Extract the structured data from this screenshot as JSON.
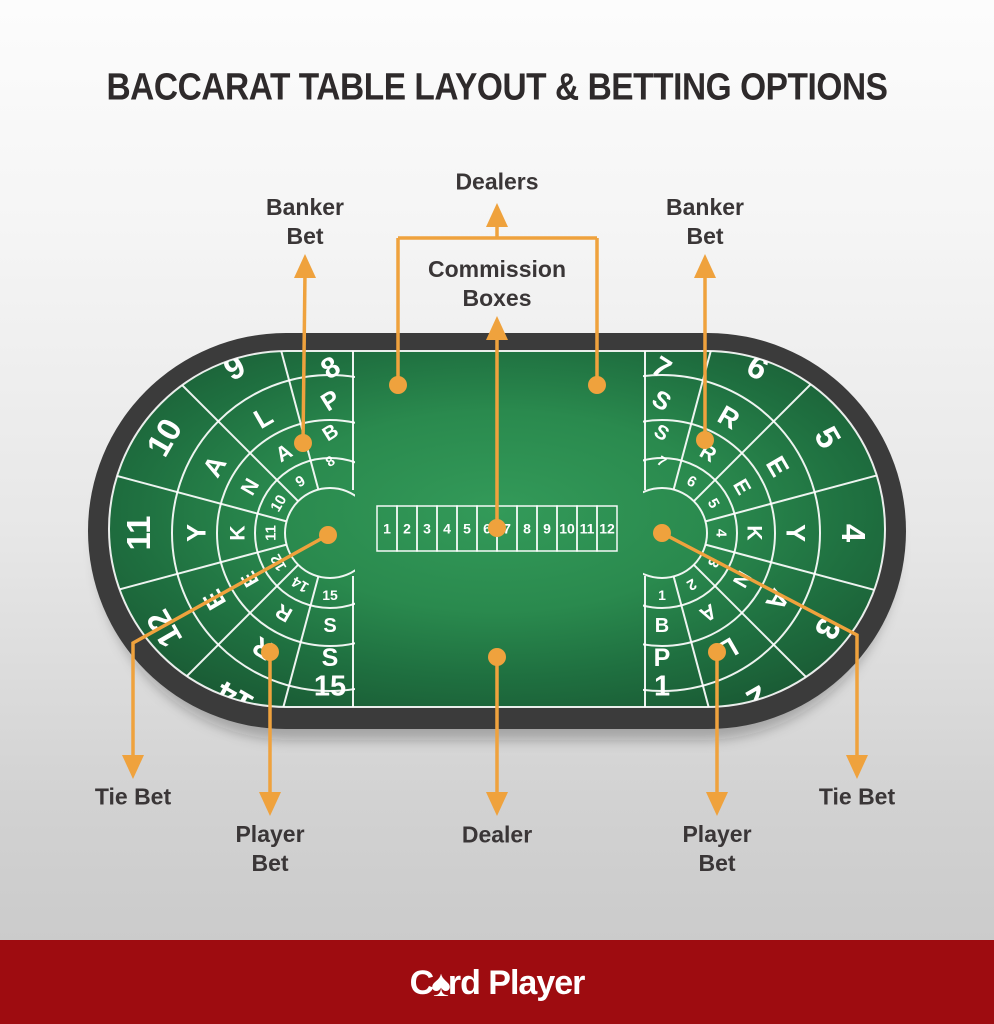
{
  "title": "BACCARAT TABLE LAYOUT & BETTING OPTIONS",
  "callouts": {
    "banker_left": [
      "Banker",
      "Bet"
    ],
    "dealers": [
      "Dealers"
    ],
    "commission": [
      "Commission",
      "Boxes"
    ],
    "banker_right": [
      "Banker",
      "Bet"
    ],
    "tie_left": [
      "Tie Bet"
    ],
    "player_left": [
      "Player",
      "Bet"
    ],
    "dealer": [
      "Dealer"
    ],
    "player_right": [
      "Player",
      "Bet"
    ],
    "tie_right": [
      "Tie Bet"
    ]
  },
  "table": {
    "commission_boxes": [
      "1",
      "2",
      "3",
      "4",
      "5",
      "6",
      "7",
      "8",
      "9",
      "10",
      "11",
      "12"
    ],
    "left_fan": {
      "seats": [
        "8",
        "9",
        "10",
        "11",
        "12",
        "14",
        "15"
      ],
      "players_ring": [
        "P",
        "L",
        "A",
        "Y",
        "E",
        "R",
        "S"
      ],
      "bankers_ring": [
        "B",
        "A",
        "N",
        "K",
        "E",
        "R",
        "S"
      ],
      "tie_numbers": [
        "8",
        "9",
        "10",
        "11",
        "12",
        "14",
        "15"
      ]
    },
    "right_fan": {
      "seats": [
        "7",
        "6",
        "5",
        "4",
        "3",
        "2",
        "1"
      ],
      "players_ring": [
        "S",
        "R",
        "E",
        "Y",
        "A",
        "L",
        "P"
      ],
      "bankers_ring": [
        "S",
        "R",
        "E",
        "K",
        "N",
        "A",
        "B"
      ],
      "tie_numbers": [
        "7",
        "6",
        "5",
        "4",
        "3",
        "2",
        "1"
      ]
    }
  },
  "footer": {
    "brand_prefix": "C",
    "brand_spade": "♠",
    "brand_suffix": "rd Player"
  },
  "colors": {
    "accent_orange": "#EFA23D",
    "rim": "#3b3b3b",
    "felt_center": "#339a59",
    "felt_mid": "#2a8a4e",
    "felt_deep": "#1f7040",
    "felt_edge": "#1a5c35",
    "line_white": "#ffffff",
    "footer_red": "#9e0c10",
    "text_dark": "#3a3637"
  }
}
